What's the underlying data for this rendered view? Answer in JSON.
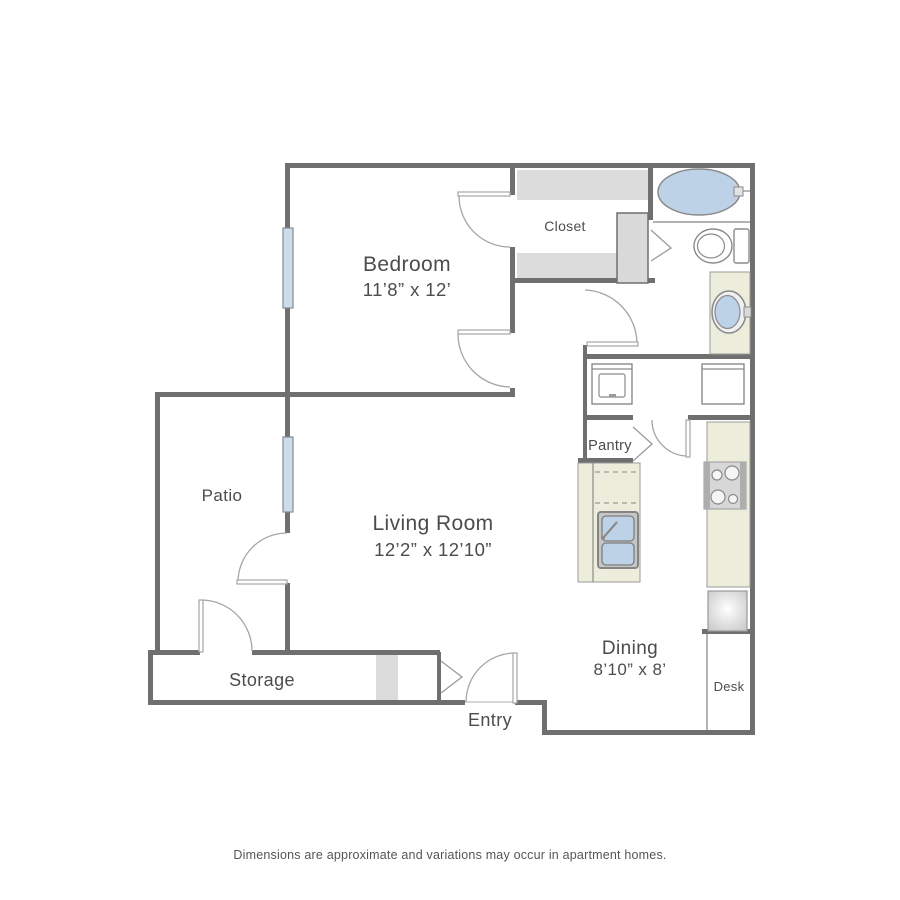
{
  "colors": {
    "wall": "#6f6f6f",
    "line": "#9a9a9a",
    "counter": "#ededdb",
    "water": "#bdd2e6",
    "shelf": "#dcdcdc",
    "block": "#d9d9d9",
    "text": "#4c4c4c"
  },
  "floorplan": {
    "rooms": {
      "bedroom": {
        "label": "Bedroom",
        "dims": "11’8” x 12’"
      },
      "living_room": {
        "label": "Living Room",
        "dims": "12’2” x 12’10”"
      },
      "dining": {
        "label": "Dining",
        "dims": "8’10” x 8’"
      },
      "patio": {
        "label": "Patio"
      },
      "storage": {
        "label": "Storage"
      },
      "entry": {
        "label": "Entry"
      },
      "closet": {
        "label": "Closet"
      },
      "pantry": {
        "label": "Pantry"
      },
      "desk": {
        "label": "Desk"
      }
    },
    "fixtures": {
      "bathtub": "bathtub",
      "toilet": "toilet",
      "vanity_sink": "vanity-sink",
      "washer": "washer",
      "dryer": "dryer",
      "kitchen_sink": "double-basin-sink",
      "stove": "stove-cooktop",
      "refrigerator": "refrigerator",
      "windows": "window",
      "doors": "swing-door"
    },
    "footer": "Dimensions are approximate and variations may occur in apartment homes."
  }
}
